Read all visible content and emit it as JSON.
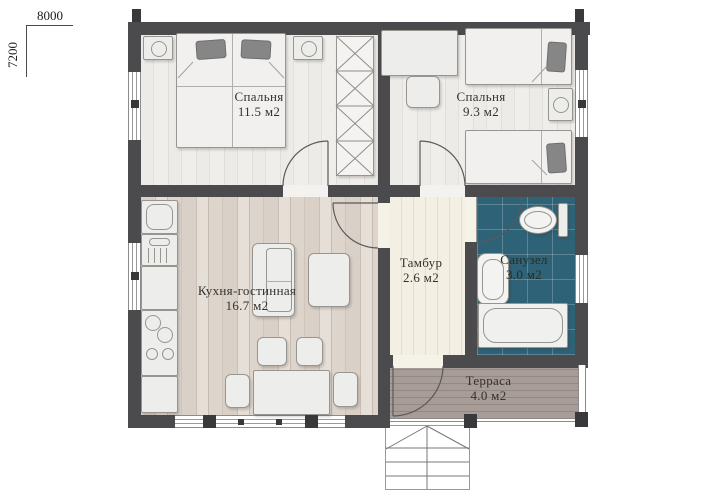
{
  "dimensions": {
    "width_label": "8000",
    "height_label": "7200"
  },
  "rooms": [
    {
      "id": "bedroom-1",
      "name": "Спальня",
      "area": "11.5 м2"
    },
    {
      "id": "bedroom-2",
      "name": "Спальня",
      "area": "9.3 м2"
    },
    {
      "id": "kitchen",
      "name": "Кухня-гостинная",
      "area": "16.7 м2"
    },
    {
      "id": "vestibule",
      "name": "Тамбур",
      "area": "2.6 м2"
    },
    {
      "id": "bathroom",
      "name": "Санузел",
      "area": "3.0 м2"
    },
    {
      "id": "terrace",
      "name": "Терраса",
      "area": "4.0 м2"
    }
  ],
  "colors": {
    "wall": "#4b4b4d",
    "wall-dark": "#39393b",
    "bathroom-tile": "#2e6276",
    "terrace-wood": "#a3978f",
    "floor-light": "#eceae6",
    "kitchen-wood": "#d8cfc6",
    "tambur-wood": "#f2eee1",
    "furniture-fill": "#ededeb",
    "furniture-stroke": "#97958f",
    "pillow": "#868686",
    "label-text": "#34322e"
  }
}
